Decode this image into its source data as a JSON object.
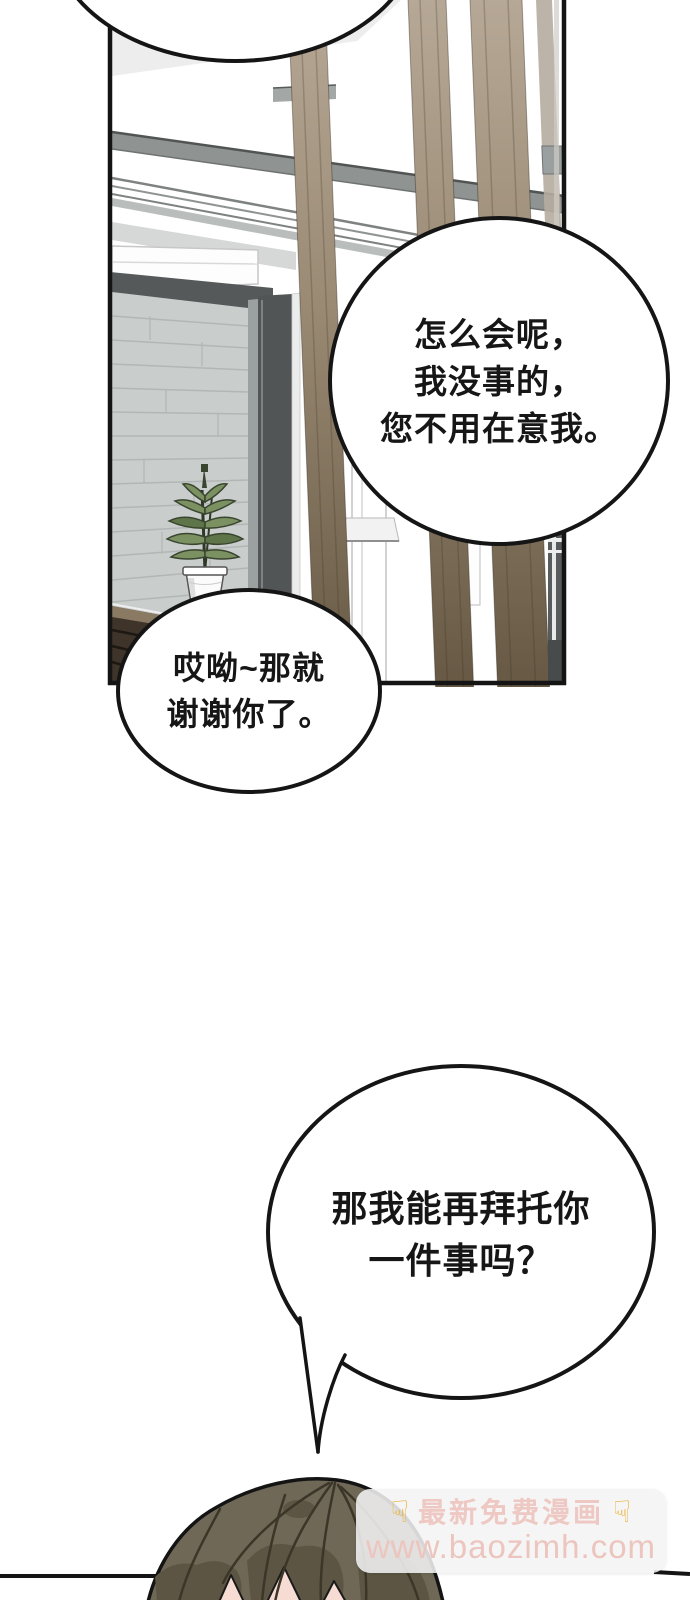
{
  "comic": {
    "bubbles": [
      {
        "id": "bubble-1",
        "lines": [
          "怎么会呢，",
          "我没事的，",
          "您不用在意我。"
        ]
      },
      {
        "id": "bubble-2",
        "lines": [
          "哎呦~那就",
          "谢谢你了。"
        ]
      },
      {
        "id": "bubble-3",
        "lines": [
          "那我能再拜托你",
          "一件事吗？"
        ]
      }
    ],
    "watermark": {
      "hand_icon": "☟",
      "title": "最新免费漫画",
      "url": "www.baozimh.com",
      "hand_color": "#e9b23c",
      "title_color": "#eec8c2",
      "url_color": "#ecc5be",
      "box_color": "rgba(243,243,243,0.87)"
    },
    "colors": {
      "ink": "#141414",
      "wood_light": "#b7a997",
      "wood_dark": "#665843",
      "brick_wall": "#c9cdcc",
      "frame_gray": "#515556",
      "beam_gray": "#8f9493",
      "hair_base": "#6f6857",
      "hair_shadow": "#5c5544",
      "skin": "#f7dcd4",
      "leaf_green": "#7b9162",
      "pot_white": "#fbfbfb"
    }
  }
}
